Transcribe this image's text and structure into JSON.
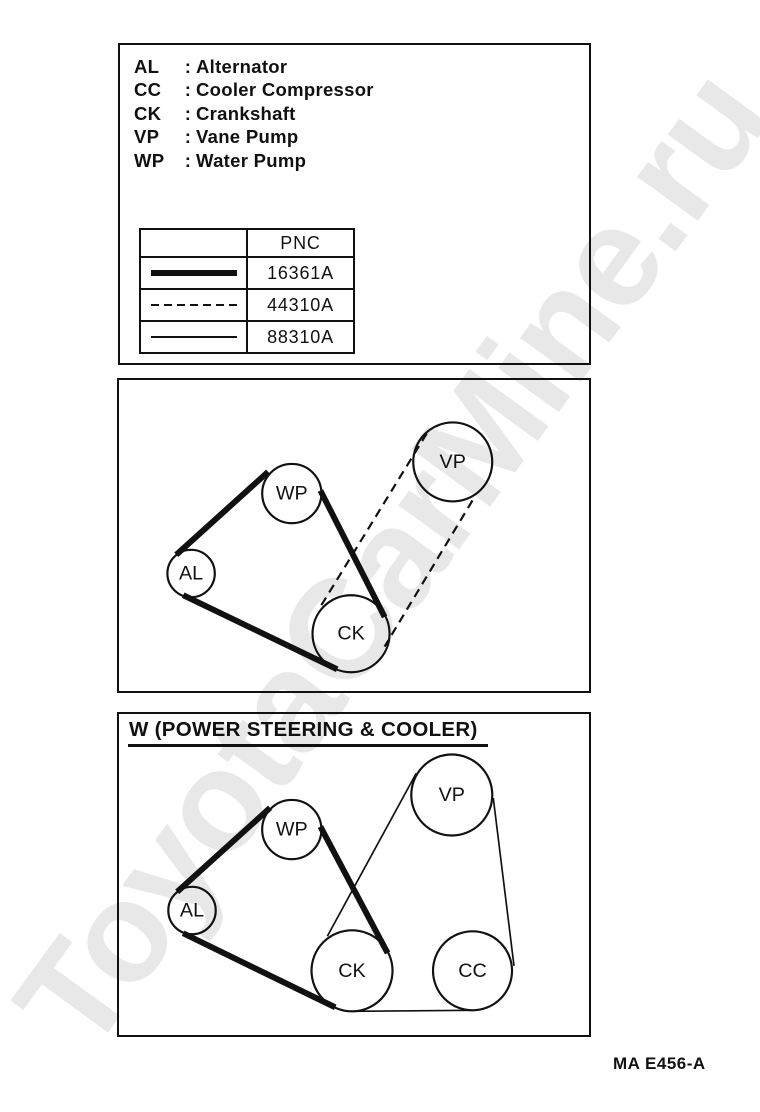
{
  "page": {
    "ink": "#111111",
    "watermark": {
      "text": "ToyotaCarMine.ru",
      "color": "#e8e8e8"
    },
    "figure_code": "MA E456-A"
  },
  "legend": {
    "items": [
      {
        "abbr": "AL",
        "sep": ":",
        "name": "Alternator"
      },
      {
        "abbr": "CC",
        "sep": ":",
        "name": "Cooler Compressor"
      },
      {
        "abbr": "CK",
        "sep": ":",
        "name": "Crankshaft"
      },
      {
        "abbr": "VP",
        "sep": ":",
        "name": "Vane Pump"
      },
      {
        "abbr": "WP",
        "sep": ":",
        "name": "Water Pump"
      }
    ]
  },
  "pnc_table": {
    "header": "PNC",
    "rows": [
      {
        "line_style": "thick",
        "pnc": "16361A"
      },
      {
        "line_style": "dashed",
        "pnc": "44310A"
      },
      {
        "line_style": "thin",
        "pnc": "88310A"
      }
    ]
  },
  "diagrams": [
    {
      "name": "belt-diagram-standard",
      "title": "",
      "width": 474,
      "height": 315,
      "pulleys": [
        {
          "label": "WP",
          "x": 174,
          "y": 115,
          "r": 30
        },
        {
          "label": "AL",
          "x": 72,
          "y": 196,
          "r": 24
        },
        {
          "label": "CK",
          "x": 234,
          "y": 257,
          "r": 39
        },
        {
          "label": "VP",
          "x": 337,
          "y": 83,
          "r": 40
        }
      ],
      "belts": [
        {
          "style": "thick",
          "pnc": "16361A",
          "segments": [
            [
              57,
              177,
              150,
              93
            ],
            [
              203,
              112,
              268,
              240
            ],
            [
              220,
              293,
              64,
              218
            ]
          ]
        },
        {
          "style": "dashed",
          "pnc": "44310A",
          "segments": [
            [
              204,
              228,
              312,
              52
            ],
            [
              357,
              122,
              268,
              270
            ]
          ]
        }
      ]
    },
    {
      "name": "belt-diagram-power-steering-cooler",
      "title": "W (POWER STEERING & COOLER)",
      "width": 474,
      "height": 325,
      "pulleys": [
        {
          "label": "WP",
          "x": 174,
          "y": 117,
          "r": 30
        },
        {
          "label": "AL",
          "x": 73,
          "y": 199,
          "r": 24
        },
        {
          "label": "CK",
          "x": 235,
          "y": 260,
          "r": 41
        },
        {
          "label": "VP",
          "x": 336,
          "y": 82,
          "r": 41
        },
        {
          "label": "CC",
          "x": 357,
          "y": 260,
          "r": 40
        }
      ],
      "belts": [
        {
          "style": "thick",
          "pnc": "16361A",
          "segments": [
            [
              58,
              180,
              152,
              95
            ],
            [
              203,
              114,
              271,
              242
            ],
            [
              218,
              297,
              64,
              222
            ]
          ]
        },
        {
          "style": "thin",
          "pnc": "88310A",
          "segments": [
            [
              210,
              225,
              300,
              60
            ],
            [
              378,
              85,
              399,
              255
            ],
            [
              357,
              300,
              235,
              301
            ]
          ]
        }
      ]
    }
  ]
}
